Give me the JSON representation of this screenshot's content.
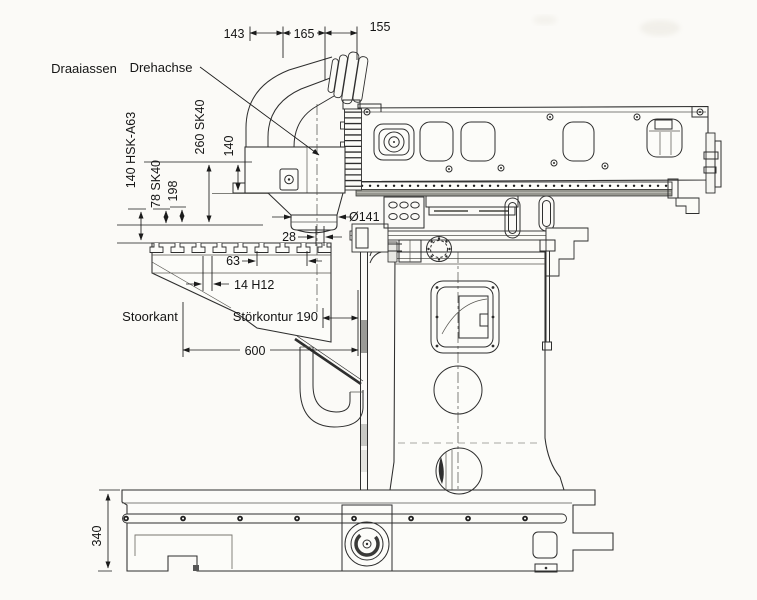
{
  "labels": {
    "draaiassen": "Draaiassen",
    "drehachse": "Drehachse",
    "stoorkant": "Stoorkant",
    "stoerkontur_190": "Störkontur 190"
  },
  "dimensions": {
    "d143": "143",
    "d165": "165",
    "d155": "155",
    "d260sk40": "260 SK40",
    "d140": "140",
    "d140hsk": "140 HSK-A63",
    "d78sk40": "78 SK40",
    "d198": "198",
    "d141dia": "Ø141",
    "d28": "28",
    "d63": "63",
    "d14h12": "14 H12",
    "d600": "600",
    "d340": "340"
  },
  "colors": {
    "paper": "#fbfaf7",
    "ink": "#2e2e2e",
    "dim_ink": "#1b1b1b"
  }
}
